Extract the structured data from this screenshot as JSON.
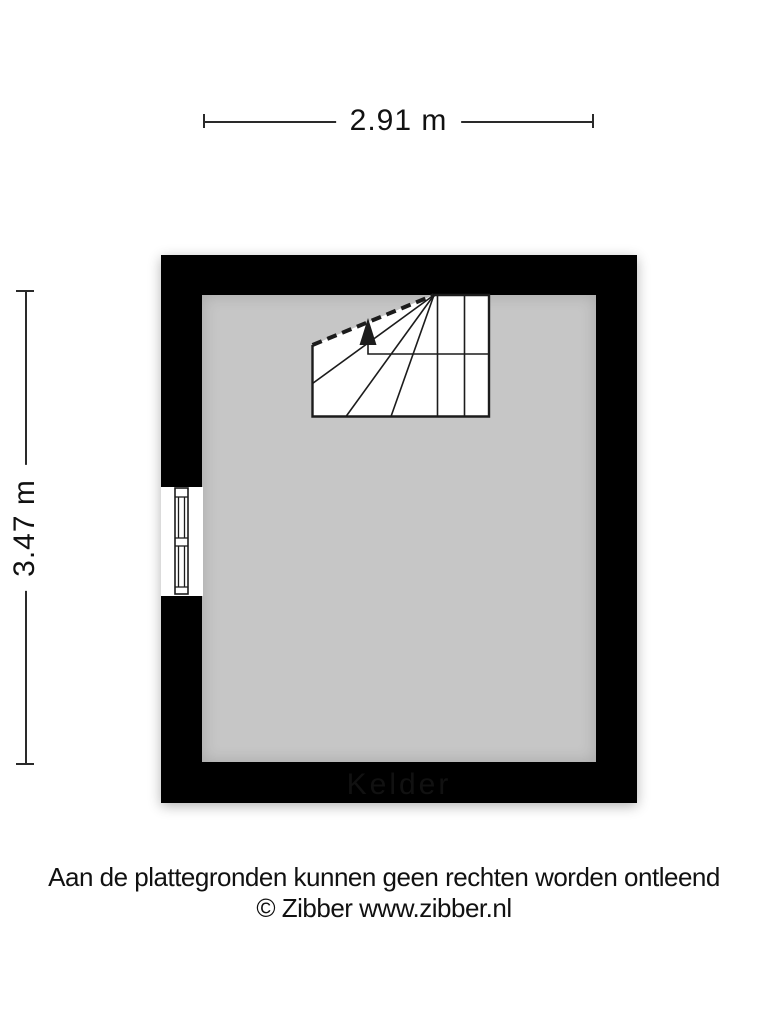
{
  "dimensions": {
    "width_label": "2.91 m",
    "height_label": "3.47 m"
  },
  "room": {
    "label": "Kelder"
  },
  "footer": {
    "disclaimer": "Aan de plattegronden kunnen geen rechten worden ontleend",
    "copyright": "© Zibber www.zibber.nl"
  },
  "icons": {
    "staircase": "staircase-with-up-arrow",
    "window": "double-casement-window",
    "arrow": "up-arrow"
  },
  "colors": {
    "wall": "#000000",
    "floor": "#c6c6c6",
    "dimension_line": "#2a2a2a",
    "background": "#ffffff"
  }
}
